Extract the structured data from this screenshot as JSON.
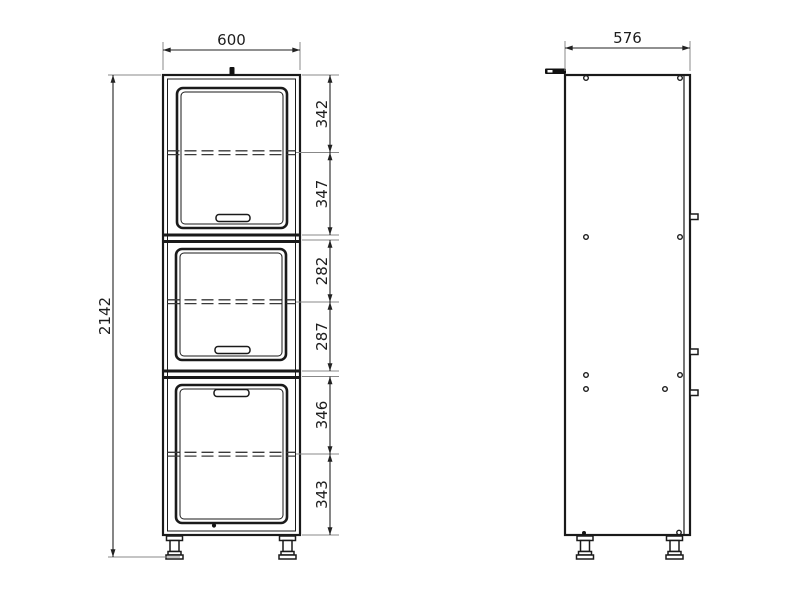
{
  "front_view": {
    "width": "600",
    "height": "2142",
    "section_dims": [
      "342",
      "347",
      "282",
      "287",
      "346",
      "343"
    ]
  },
  "side_view": {
    "depth": "576"
  },
  "colors": {
    "line": "#1a1a1a",
    "dimension_text": "#1d1d1d",
    "extension_line": "#888888",
    "background": "#ffffff"
  }
}
